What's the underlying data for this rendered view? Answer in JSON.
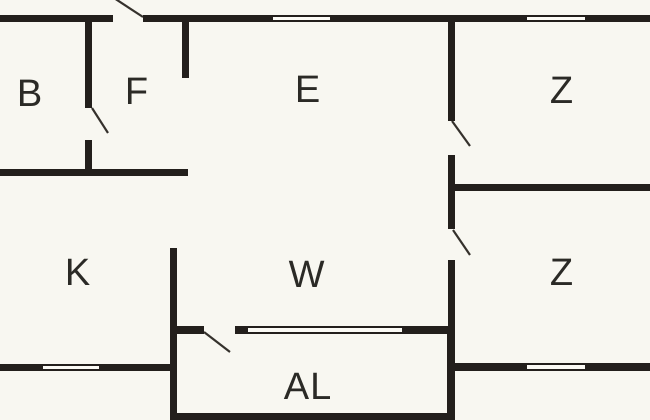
{
  "diagram_type": "floor-plan",
  "colors": {
    "background": "#f8f7f1",
    "wall": "#231f1c",
    "door_line": "#35312c",
    "label": "#2b2a26"
  },
  "rooms": [
    {
      "id": "room-b",
      "label": "B",
      "cx": 30,
      "cy": 94
    },
    {
      "id": "room-f",
      "label": "F",
      "cx": 137,
      "cy": 92
    },
    {
      "id": "room-e",
      "label": "E",
      "cx": 308,
      "cy": 90
    },
    {
      "id": "room-z-upper",
      "label": "Z",
      "cx": 562,
      "cy": 91
    },
    {
      "id": "room-k",
      "label": "K",
      "cx": 78,
      "cy": 273
    },
    {
      "id": "room-w",
      "label": "W",
      "cx": 307,
      "cy": 275
    },
    {
      "id": "room-z-lower",
      "label": "Z",
      "cx": 562,
      "cy": 273
    },
    {
      "id": "room-al",
      "label": "AL",
      "cx": 308,
      "cy": 387
    }
  ],
  "walls": [
    {
      "name": "top-wall-left",
      "x": 0,
      "y": 15,
      "w": 113,
      "h": 7
    },
    {
      "name": "top-wall-mid-left",
      "x": 143,
      "y": 15,
      "w": 130,
      "h": 7
    },
    {
      "name": "top-wall-mid-right",
      "x": 330,
      "y": 15,
      "w": 197,
      "h": 7
    },
    {
      "name": "top-wall-right",
      "x": 585,
      "y": 15,
      "w": 65,
      "h": 7
    },
    {
      "name": "b-f-divider-upper",
      "x": 85,
      "y": 22,
      "w": 7,
      "h": 86
    },
    {
      "name": "b-f-divider-lower",
      "x": 85,
      "y": 140,
      "w": 7,
      "h": 36
    },
    {
      "name": "f-e-divider",
      "x": 182,
      "y": 22,
      "w": 7,
      "h": 56
    },
    {
      "name": "bf-k-divider",
      "x": 0,
      "y": 169,
      "w": 188,
      "h": 7
    },
    {
      "name": "e-z-divider-upper",
      "x": 448,
      "y": 22,
      "w": 7,
      "h": 99
    },
    {
      "name": "e-z-divider-lower",
      "x": 448,
      "y": 155,
      "w": 7,
      "h": 36
    },
    {
      "name": "z-z-divider",
      "x": 448,
      "y": 184,
      "w": 202,
      "h": 7
    },
    {
      "name": "w-z-divider-upper",
      "x": 448,
      "y": 191,
      "w": 7,
      "h": 38
    },
    {
      "name": "w-z-divider-lower",
      "x": 448,
      "y": 260,
      "w": 7,
      "h": 74
    },
    {
      "name": "k-w-al-left-wall",
      "x": 170,
      "y": 248,
      "w": 7,
      "h": 172
    },
    {
      "name": "k-bottom-wall-left",
      "x": 0,
      "y": 364,
      "w": 43,
      "h": 7
    },
    {
      "name": "k-bottom-wall-right",
      "x": 99,
      "y": 364,
      "w": 78,
      "h": 7
    },
    {
      "name": "w-al-wall-left",
      "x": 170,
      "y": 326,
      "w": 34,
      "h": 8
    },
    {
      "name": "w-al-wall-mid",
      "x": 235,
      "y": 326,
      "w": 13,
      "h": 8
    },
    {
      "name": "w-al-wall-right",
      "x": 402,
      "y": 326,
      "w": 53,
      "h": 8
    },
    {
      "name": "al-right-wall",
      "x": 447,
      "y": 326,
      "w": 8,
      "h": 94
    },
    {
      "name": "z-bottom-wall-left",
      "x": 455,
      "y": 363,
      "w": 72,
      "h": 8
    },
    {
      "name": "z-bottom-wall-right",
      "x": 585,
      "y": 363,
      "w": 65,
      "h": 8
    },
    {
      "name": "al-bottom-wall",
      "x": 170,
      "y": 413,
      "w": 285,
      "h": 7
    }
  ],
  "windows": [
    {
      "name": "window-e-top",
      "x": 273,
      "y": 15,
      "w": 57,
      "h": 7
    },
    {
      "name": "window-z-upper-top",
      "x": 527,
      "y": 15,
      "w": 58,
      "h": 7
    },
    {
      "name": "window-k-bottom",
      "x": 43,
      "y": 364,
      "w": 56,
      "h": 7
    },
    {
      "name": "window-al-top",
      "x": 248,
      "y": 326,
      "w": 154,
      "h": 8
    },
    {
      "name": "window-z-lower-bottom",
      "x": 527,
      "y": 363,
      "w": 58,
      "h": 8
    }
  ],
  "doors": [
    {
      "name": "door-f-exterior",
      "x1": 114,
      "y1": -2,
      "x2": 143,
      "y2": 17
    },
    {
      "name": "door-b",
      "x1": 92,
      "y1": 108,
      "x2": 108,
      "y2": 133
    },
    {
      "name": "door-z-upper",
      "x1": 452,
      "y1": 121,
      "x2": 470,
      "y2": 146
    },
    {
      "name": "door-z-lower",
      "x1": 453,
      "y1": 230,
      "x2": 470,
      "y2": 255
    },
    {
      "name": "door-al",
      "x1": 204,
      "y1": 332,
      "x2": 230,
      "y2": 352
    }
  ]
}
